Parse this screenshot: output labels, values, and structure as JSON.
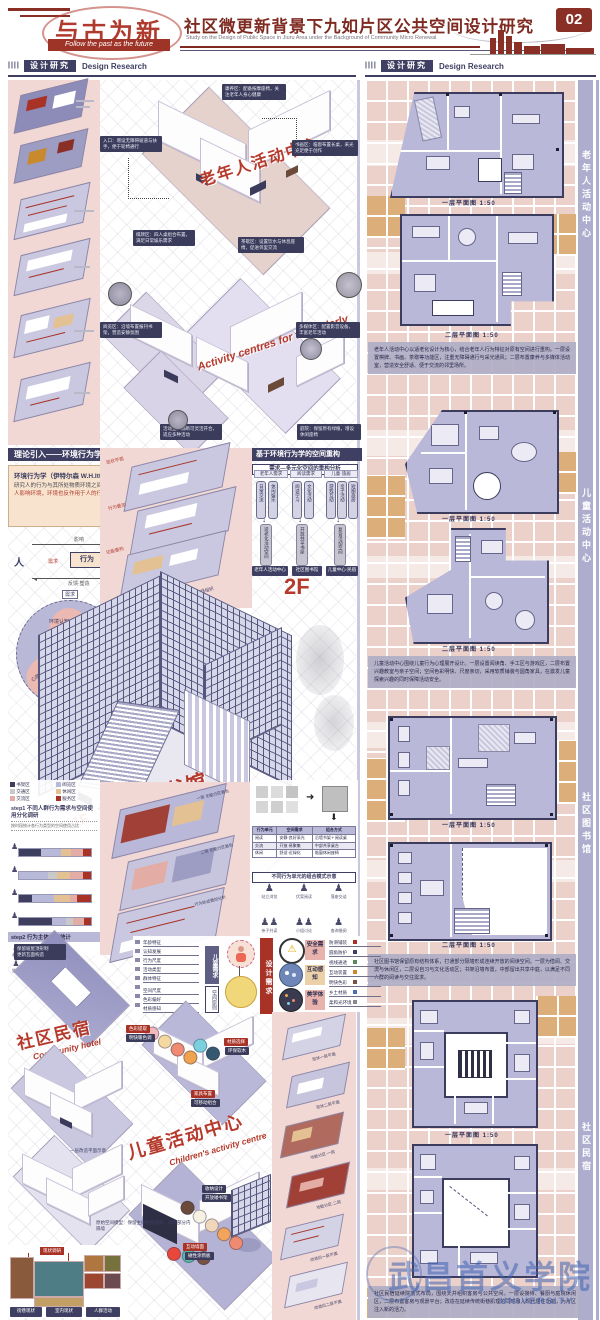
{
  "colors": {
    "accent_red": "#a93226",
    "navy": "#3f3f63",
    "lavender": "#b7b6d6",
    "pink": "#f2d8d5",
    "tan": "#dcae79",
    "watermark_blue": "#3f63b0",
    "legend": [
      "#3e3e5f",
      "#b8b8d8",
      "#c9c9c9",
      "#e3c193",
      "#e3aca5",
      "#a93226"
    ]
  },
  "header": {
    "logo_cn": "与古为新",
    "logo_en": "Follow the past as the future",
    "title": "社区微更新背景下九如片区公共空间设计研究",
    "subtitle_en": "Study on the Design of Public Space in Jiuru Area under the Background of Community Micro Renewal",
    "page_no": "02"
  },
  "section_header": {
    "bars": "||||",
    "cn": "设计研究",
    "en": "Design Research"
  },
  "left": {
    "iso1": {
      "title_cn": "老年人活动中心",
      "notes": [
        "入口：增设无障碍坡道与扶手，便于轮椅通行",
        "书画区：临窗布置长桌，采光充足便于创作",
        "棋牌区：四人桌组合布置，满足日常娱乐需求",
        "茶歇区：设置饮水与休息座椅，促进邻里交流",
        "康养区：配备按摩座椅，关注老年人身心健康"
      ]
    },
    "iso2": {
      "title_en": "Activity centres for the elderly",
      "notes": [
        "阅览区：沿墙布置报刊书架，营造安静氛围",
        "多媒体区：配置影音设备，丰富老年活动",
        "活动室：隔断可灵活开合，适应多种活动",
        "庭院：保留原有绿植，增设休闲座椅"
      ]
    },
    "theory": {
      "header": "理论引入——环境行为学",
      "box_title": "环境行为学（伊特尔森 W.H.Ittelson）",
      "box_text1": "研究人的行为与其所处物质环境之间的相互关系，",
      "box_text2": "人影响环境，环境也反作用于人的行为与心理。",
      "diagram": {
        "person": "人",
        "behavior": "行为",
        "env": "环 境",
        "arrow_top": "影响",
        "arrow_mid": "需求",
        "arrow_bottom": "反馈·塑造"
      },
      "circle": {
        "tag": "需求",
        "center": "行为",
        "top": "环境认知",
        "lv": "心理需求",
        "rv": "行为习惯"
      }
    },
    "explode_mid": {
      "labels": [
        "现状平面",
        "行为叠加",
        "功能重构",
        "流线组织"
      ]
    },
    "recon": {
      "header": "基于环境行为学的空间重构",
      "sub": "需求—多元化空间的重构分析",
      "groups": [
        {
          "title": "老年人需求",
          "bars": [
            "日常交流",
            "休闲娱乐"
          ],
          "mid": "适老化活动空间",
          "result": "老年人活动中心"
        },
        {
          "title": "阅读需求",
          "bars": [
            "阅读学习",
            "文化活动"
          ],
          "mid": "开放共享书屋",
          "result": "社区图书馆"
        },
        {
          "title": "儿童·旅居",
          "bars": [
            "游戏互动",
            "亲子活动",
            "短期旅居"
          ],
          "mid": "复合活动空间",
          "result": "儿童中心·民宿"
        }
      ],
      "floor_tag_2f": "2F"
    },
    "library": {
      "floor_tag_1f": "1F",
      "title_cn": "社区图书馆",
      "title_en": "Community Library"
    },
    "stats": {
      "legend": [
        {
          "c": "#3e3e5f",
          "t": "书架区"
        },
        {
          "c": "#b8b8d8",
          "t": "阅览区"
        },
        {
          "c": "#c9c9c9",
          "t": "交通区"
        },
        {
          "c": "#e3c193",
          "t": "休闲区"
        },
        {
          "c": "#e3aca5",
          "t": "交流区"
        },
        {
          "c": "#a93226",
          "t": "服务区"
        }
      ],
      "step1_title": "step1 不同人群行为需求与空间使用分化调研",
      "step1_note": "按时段统计各行为类型的空间使用占比",
      "step2_title": "step2 行为主体类型统计",
      "row1": [
        "老人",
        "儿童",
        "青年",
        "访客"
      ],
      "row2": [
        "独处",
        "结伴",
        "群体"
      ]
    },
    "midstack": {
      "notes": [
        "一层 功能分区着色",
        "二层 功能分区着色",
        "行为轨迹叠加分析"
      ]
    },
    "combo": {
      "table": {
        "headers": [
          "行为单元",
          "空间需求",
          "组合方式"
        ],
        "rows": [
          [
            "阅读",
            "安静·良好采光",
            "沿墙书架＋阅读桌"
          ],
          [
            "交流",
            "开放·易聚集",
            "中部共享桌台"
          ],
          [
            "休闲",
            "舒适·近绿化",
            "临窗休闲座椅"
          ]
        ]
      },
      "sub": "不同行为单元的组合模式示意",
      "people": [
        "站立浏览",
        "伏案阅读",
        "落座交谈",
        "亲子共读",
        "小组讨论",
        "查询借阅"
      ]
    },
    "hotel": {
      "title_cn": "社区民宿",
      "title_en": "Community hotel",
      "roof_note": "保留坡屋顶形制\n更新瓦面构造",
      "plan_note": "一层改造平面示意"
    },
    "require": {
      "left_items": [
        "年龄特征",
        "认知发展",
        "行为尺度",
        "活动类型",
        "群体特征",
        "空间尺度",
        "色彩偏好",
        "材质感知"
      ],
      "left_boxes": [
        "儿童需求",
        "空间原则"
      ],
      "center": "设计需求",
      "right_boxes": [
        "安全需求",
        "互动感知",
        "美学体验"
      ],
      "right_items": [
        "防滑铺装",
        "圆角防护",
        "视线通透",
        "互动装置",
        "明快色彩",
        "乡土材质",
        "柔和光环境"
      ]
    },
    "children": {
      "title_cn": "儿童活动中心",
      "title_en": "Children's activity centre",
      "chips": [
        {
          "t": "色彩提取"
        },
        {
          "t": "明快暖色调"
        },
        {
          "t": "材质选择"
        },
        {
          "t": "环保软木"
        },
        {
          "t": "家具布置"
        },
        {
          "t": "可移动组合"
        },
        {
          "t": "收纳设计"
        },
        {
          "t": "开放矮书架"
        },
        {
          "t": "互动墙面"
        },
        {
          "t": "磁性涂鸦板"
        }
      ],
      "palette_a": [
        "#6b4a3a",
        "#f7f1e4",
        "#f0d7bb",
        "#f2a45c",
        "#ee8b70"
      ],
      "palette_b": [
        "#e8473a",
        "#56b8a7",
        "#7a5244"
      ],
      "palette_c": [
        "#f2b8ba",
        "#f5d7a0",
        "#ee8b70",
        "#f0a34f"
      ],
      "palette_d": [
        "#7ad0dd",
        "#35586e"
      ]
    },
    "model_note": "原始空间模型：保留主体结构墙体，拆除部分内隔墙",
    "collage": {
      "tag": "现状调研",
      "labels": [
        "街巷现状",
        "室内现状",
        "人群活动"
      ]
    },
    "strip": {
      "notes": [
        "现状一层平面",
        "现状二层平面",
        "功能分区·一层",
        "功能分区·二层",
        "改造后一层平面",
        "改造后二层平面"
      ]
    }
  },
  "right": {
    "sections": [
      {
        "label": "老年人活动中心",
        "plans": [
          {
            "caption": "一层平面图 1:50"
          },
          {
            "caption": "二层平面图 1:50"
          }
        ],
        "para": "老年人活动中心以适老化设计为核心，结合老年人行为特征对原有空间进行重构。一层设置棋牌、书画、茶歇等功能区，注重无障碍通行与采光通风；二层布置康养与多媒体活动室，营造安全舒适、便于交流的邻里场所。"
      },
      {
        "label": "儿童活动中心",
        "plans": [
          {
            "caption": "一层平面图 1:50"
          },
          {
            "caption": "二层平面图 1:50"
          }
        ],
        "para": "儿童活动中心围绕儿童行为心理展开设计。一层设置阅读角、手工区与游戏区，二层布置兴趣教室与亲子空间；空间色彩明快、尺度亲切，采用软质铺装与圆角家具，在激发儿童探索兴趣的同时保障活动安全。"
      },
      {
        "label": "社区图书馆",
        "plans": [
          {
            "caption": "一层平面图 1:50"
          },
          {
            "caption": "二层平面图 1:50"
          }
        ],
        "para": "社区图书馆保留原有结构体系，打通部分隔墙形成连续开放的阅读空间。一层为借阅、交流与休闲区，二层设自习与文化活动区；书架沿墙布置，中部留出共享中庭，以满足不同人群的阅读与交往需求。"
      },
      {
        "label": "社区民宿",
        "plans": [
          {
            "caption": "一层平面图 1:50"
          },
          {
            "caption": "二层平面图 1:50"
          }
        ],
        "para": "社区民宿延续院落式布局，围绕天井组织客房与公共空间。一层设接待、餐厨与庭院休闲区，二层布置客房与观景平台；改造在延续传统街巷肌理的同时融入现代居住功能，为片区注入新的活力。"
      }
    ],
    "watermark": {
      "cn": "武昌首义学院",
      "en": "UNIVERSITY"
    }
  }
}
